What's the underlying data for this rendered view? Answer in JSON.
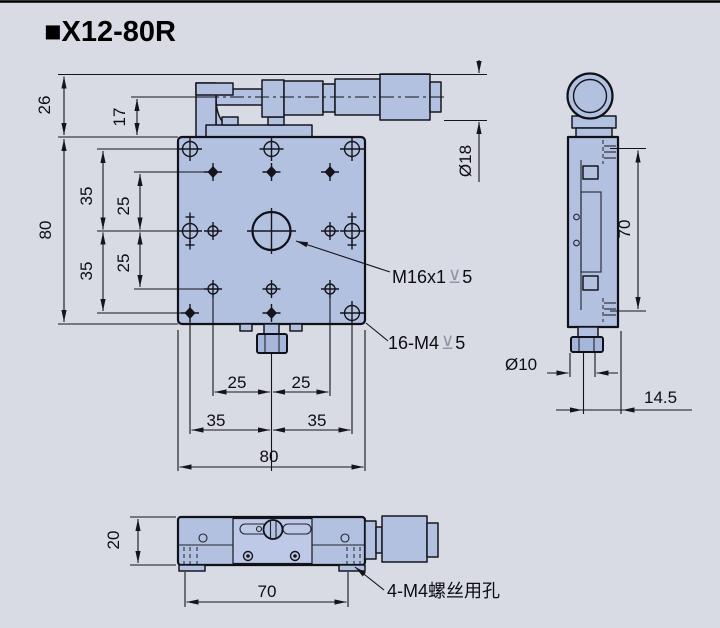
{
  "title": "■X12-80R",
  "front_view": {
    "dim_26": "26",
    "dim_17": "17",
    "dim_80_left": "80",
    "dim_35_upper": "35",
    "dim_25_upper": "25",
    "dim_25_lower": "25",
    "dim_35_lower": "35",
    "dim_dia18": "Ø18",
    "dim_25_bottom_left": "25",
    "dim_25_bottom_right": "25",
    "dim_35_bottom_left": "35",
    "dim_35_bottom_right": "35",
    "dim_80_bottom": "80",
    "label_center_thread": "M16x1",
    "label_center_depth": "5",
    "label_grid_holes": "16-M4",
    "label_grid_depth": "5",
    "depth_symbol": "⊻"
  },
  "side_view": {
    "dim_70": "70",
    "dim_dia10": "Ø10",
    "dim_14_5": "14.5"
  },
  "bottom_view": {
    "dim_20": "20",
    "dim_70": "70",
    "label_screw_holes": "4-M4螺丝用孔"
  }
}
